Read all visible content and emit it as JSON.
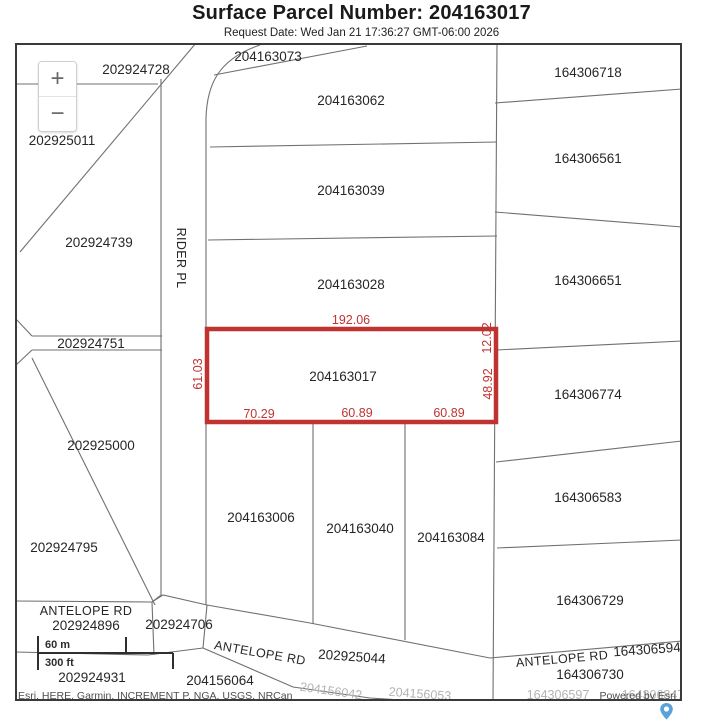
{
  "header": {
    "title": "Surface Parcel Number: 204163017",
    "request_date": "Request Date: Wed Jan 21 17:36:27 GMT-06:00 2026"
  },
  "map": {
    "controls": {
      "zoom_in": "+",
      "zoom_out": "−"
    },
    "scale_bar": {
      "metric": "60 m",
      "imperial": "300 ft"
    },
    "attribution": "Esri, HERE, Garmin, INCREMENT P, NGA, USGS, NRCan",
    "powered_by": "Powered by Esri",
    "roads": {
      "rider_pl": "RIDER PL",
      "antelope_west": "ANTELOPE RD",
      "antelope_center": "ANTELOPE RD",
      "antelope_east": "ANTELOPE RD"
    },
    "highlight": {
      "parcel": "204163017",
      "color": "#bf3331",
      "dim_top": "192.06",
      "dim_left": "61.03",
      "dim_bottom": [
        "70.29",
        "60.89",
        "60.89"
      ],
      "dim_right_upper": "12.02",
      "dim_right_lower": "48.92"
    },
    "parcels": {
      "left": [
        "202924728",
        "202925011",
        "202924739",
        "202924751",
        "202925000",
        "202924795",
        "202924896",
        "202924706",
        "202924931"
      ],
      "middle": [
        "204163073",
        "204163062",
        "204163039",
        "204163028",
        "204163006",
        "204163040",
        "204163084"
      ],
      "right": [
        "164306718",
        "164306561",
        "164306651",
        "164306774",
        "164306583",
        "164306729",
        "164306594",
        "164306730"
      ],
      "bottom": [
        "204156064",
        "202925044"
      ]
    },
    "basemap_labels": [
      "204156042",
      "204156053",
      "164306597",
      "164306847"
    ]
  }
}
